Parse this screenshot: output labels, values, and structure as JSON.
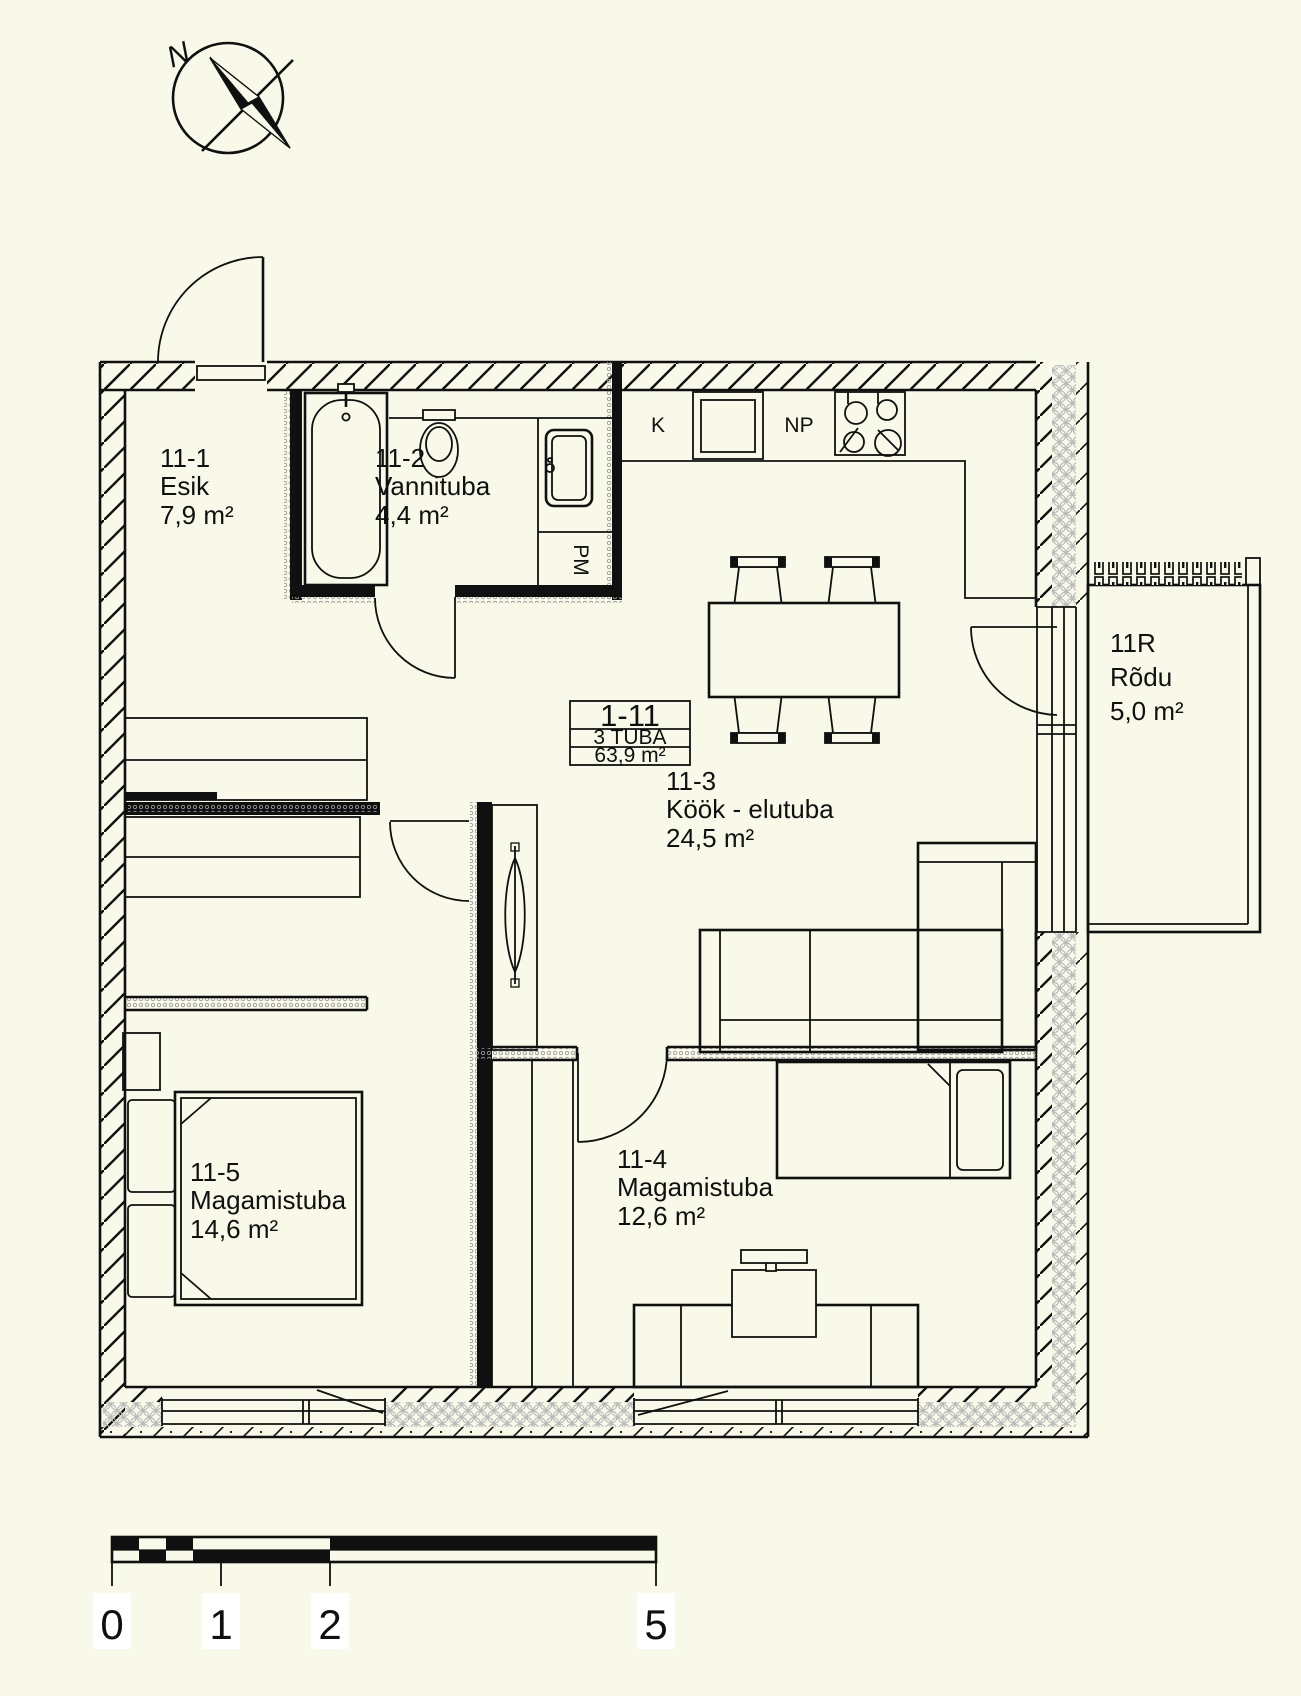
{
  "compass": {
    "north_label": "N"
  },
  "unit_card": {
    "unit_number": "1-11",
    "unit_type": "3 TUBA",
    "total_area": "63,9 m²"
  },
  "rooms": {
    "esik": {
      "id": "11-1",
      "name": "Esik",
      "area": "7,9 m²"
    },
    "vannituba": {
      "id": "11-2",
      "name": "Vannituba",
      "area": "4,4 m²"
    },
    "kook_elutuba": {
      "id": "11-3",
      "name": "Köök - elutuba",
      "area": "24,5 m²"
    },
    "magamistuba_1": {
      "id": "11-4",
      "name": "Magamistuba",
      "area": "12,6 m²"
    },
    "magamistuba_2": {
      "id": "11-5",
      "name": "Magamistuba",
      "area": "14,6 m²"
    },
    "rodu": {
      "id": "11R",
      "name": "Rõdu",
      "area": "5,0 m²"
    }
  },
  "appliance_labels": {
    "fridge": "K",
    "stove": "NP",
    "washing_machine": "PM"
  },
  "scale_bar": {
    "tick_labels": [
      "0",
      "1",
      "2",
      "5"
    ]
  },
  "colors": {
    "background": "#f8f9e8",
    "ink": "#101010",
    "insulation_gray": "#b9b9b9"
  }
}
